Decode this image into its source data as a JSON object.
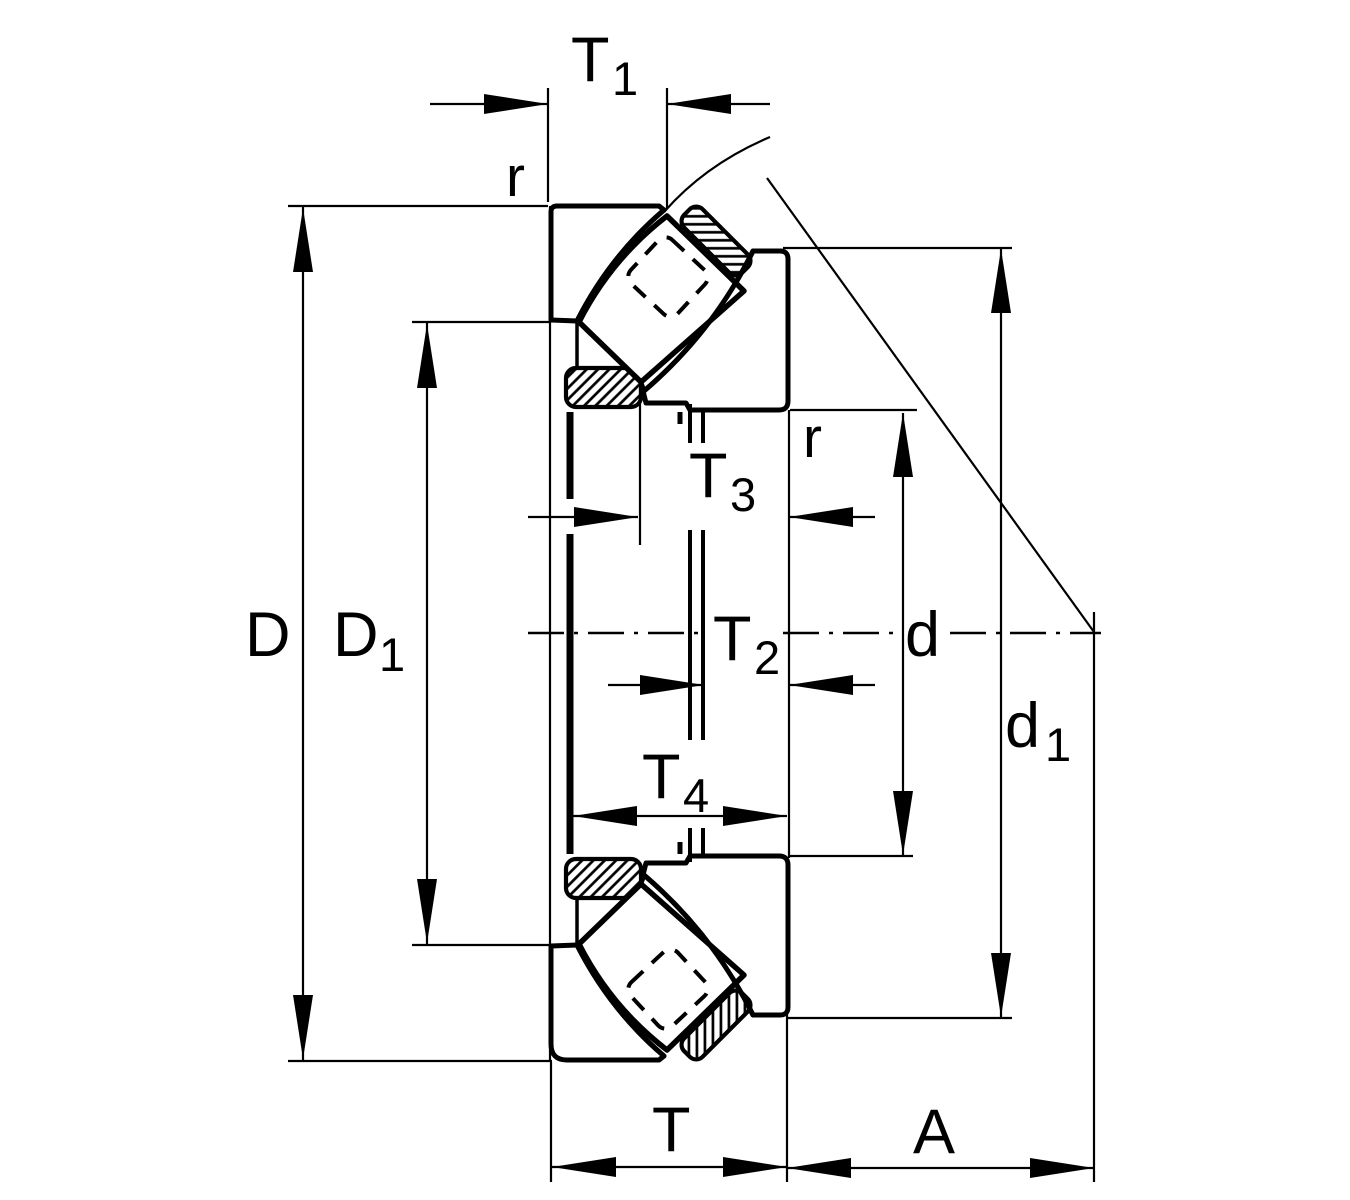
{
  "drawing": {
    "description": "Spherical roller thrust bearing cross-section dimension drawing",
    "background_color": "#ffffff",
    "line_color": "#000000",
    "labels": {
      "T1": {
        "base": "T",
        "sub": "1"
      },
      "T2": {
        "base": "T",
        "sub": "2"
      },
      "T3": {
        "base": "T",
        "sub": "3"
      },
      "T4": {
        "base": "T",
        "sub": "4"
      },
      "T": {
        "base": "T"
      },
      "A": {
        "base": "A"
      },
      "D": {
        "base": "D"
      },
      "D1": {
        "base": "D",
        "sub": "1"
      },
      "d": {
        "base": "d"
      },
      "d1": {
        "base": "d",
        "sub": "1"
      },
      "r_outer": {
        "base": "r"
      },
      "r_inner": {
        "base": "r"
      }
    }
  }
}
